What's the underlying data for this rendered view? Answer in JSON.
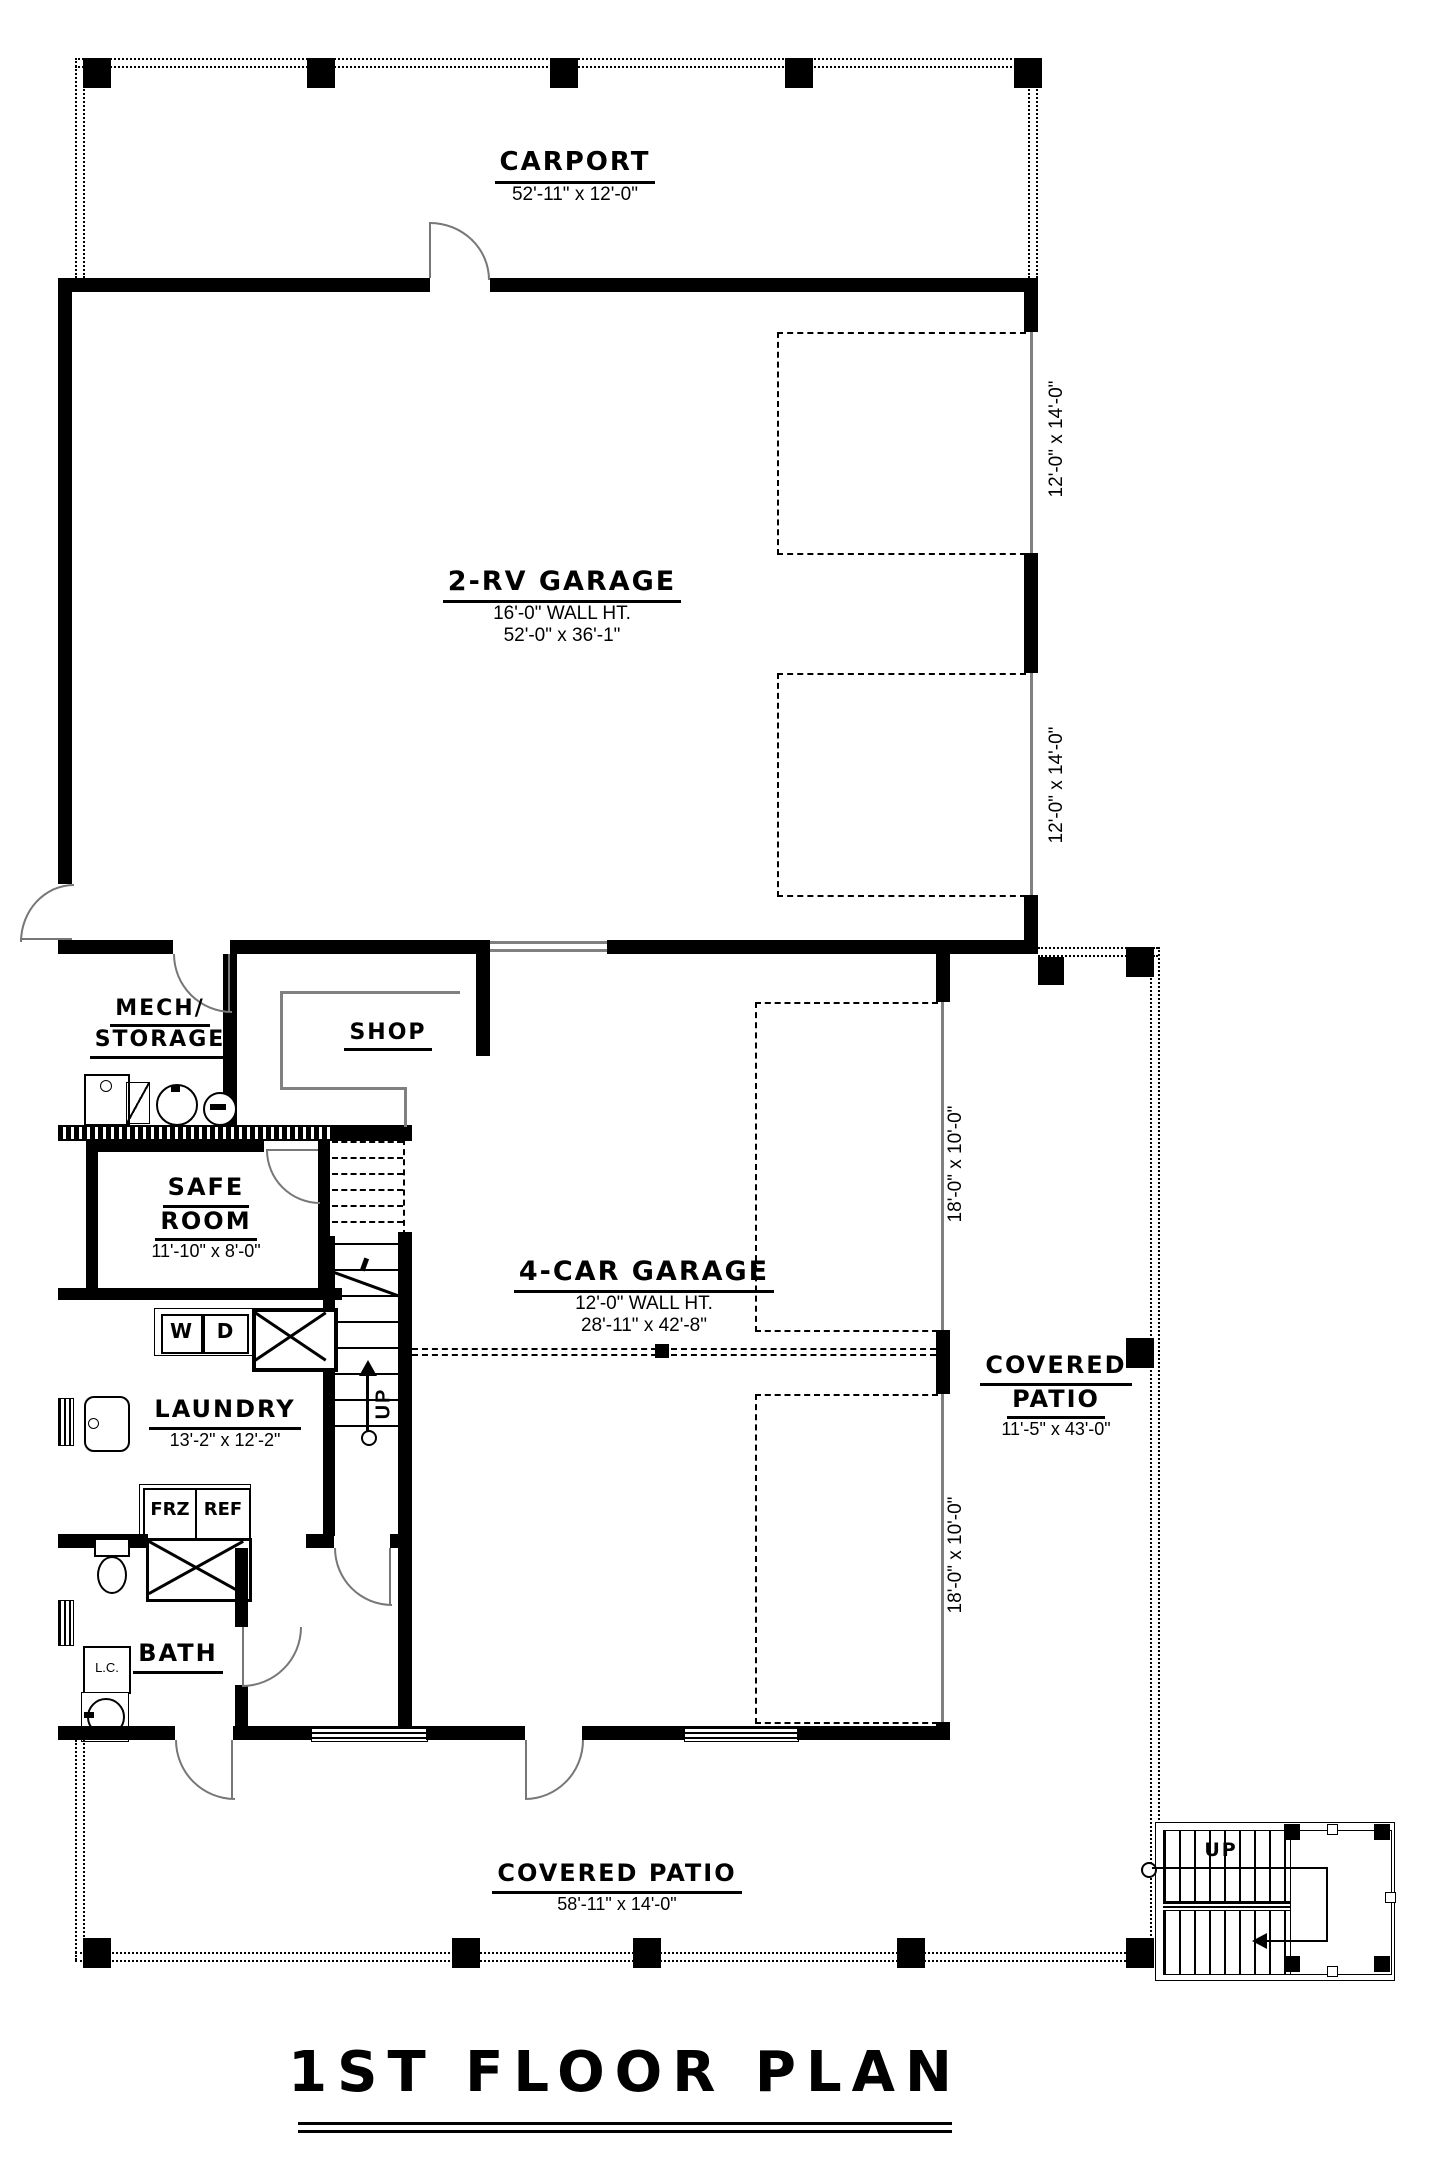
{
  "title": "1ST FLOOR PLAN",
  "carport": {
    "name": "CARPORT",
    "dims": "52'-11\" x 12'-0\""
  },
  "rv_garage": {
    "name": "2-RV GARAGE",
    "wall_ht": "16'-0\" WALL HT.",
    "dims": "52'-0\" x 36'-1\"",
    "door1_dims": "12'-0\" x 14'-0\"",
    "door2_dims": "12'-0\" x 14'-0\""
  },
  "mech_storage": {
    "line1": "MECH/",
    "line2": "STORAGE"
  },
  "shop": {
    "name": "SHOP"
  },
  "safe_room": {
    "line1": "SAFE",
    "line2": "ROOM",
    "dims": "11'-10\" x 8'-0\""
  },
  "four_car_garage": {
    "name": "4-CAR GARAGE",
    "wall_ht": "12'-0\" WALL HT.",
    "dims": "28'-11\" x 42'-8\"",
    "door1_dims": "18'-0\" x 10'-0\"",
    "door2_dims": "18'-0\" x 10'-0\""
  },
  "patio_right": {
    "line1": "COVERED",
    "line2": "PATIO",
    "dims": "11'-5\" x 43'-0\""
  },
  "laundry": {
    "name": "LAUNDRY",
    "dims": "13'-2\" x 12'-2\"",
    "washer": "W",
    "dryer": "D",
    "freezer": "FRZ",
    "fridge": "REF"
  },
  "bath": {
    "name": "BATH",
    "linen": "L.C."
  },
  "patio_bottom": {
    "name": "COVERED PATIO",
    "dims": "58'-11\" x 14'-0\""
  },
  "stairs": {
    "up_interior": "UP",
    "up_exterior": "UP"
  },
  "colors": {
    "ink": "#000000",
    "door_line": "#777777",
    "bg": "#ffffff"
  }
}
